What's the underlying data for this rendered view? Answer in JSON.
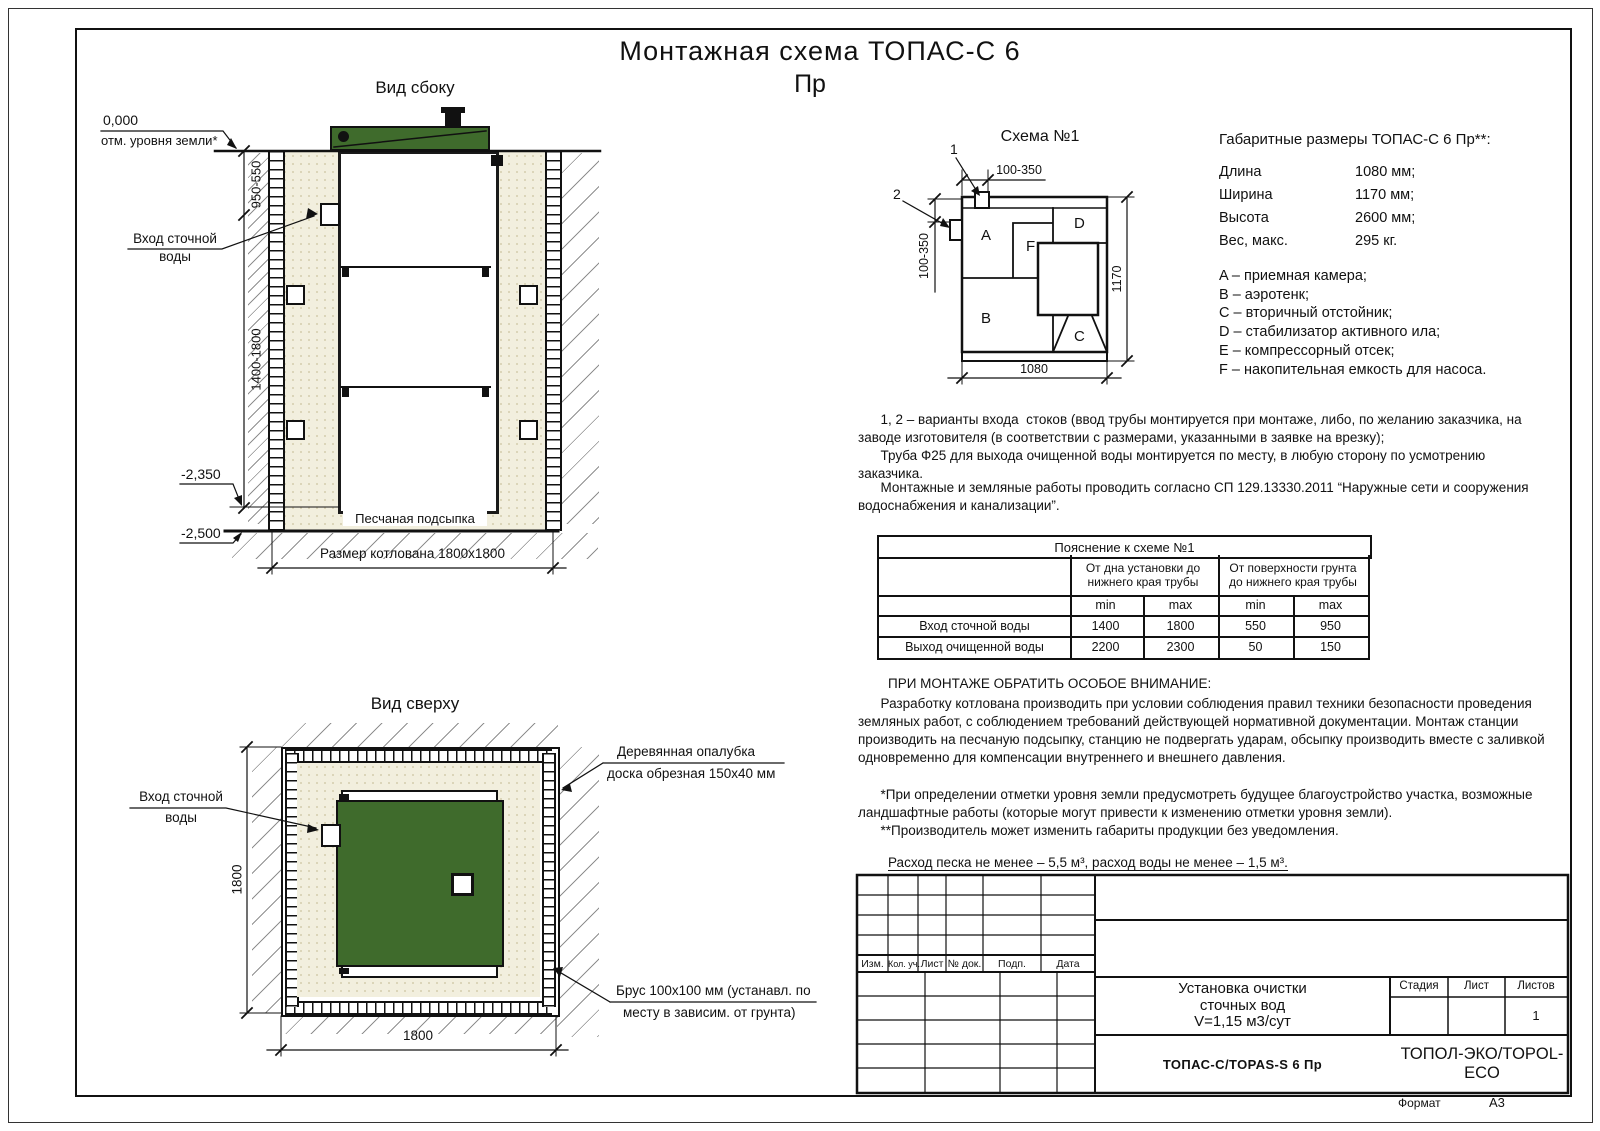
{
  "sheet": {
    "title_line1": "Монтажная схема ТОПАС-С 6",
    "title_line2": "Пр",
    "format_label": "Формат",
    "format_value": "А3"
  },
  "side_view": {
    "title": "Вид сбоку",
    "level_zero": "0,000",
    "level_zero_label": "отм. уровня земли*",
    "dim_upper": "950-550",
    "dim_lower": "1400-1800",
    "level_tank_bottom": "-2,350",
    "level_pit_bottom": "-2,500",
    "inlet_label_line1": "Вход сточной",
    "inlet_label_line2": "воды",
    "sand_label": "Песчаная подсыпка",
    "pit_dim": "Размер котлована 1800x1800"
  },
  "top_view": {
    "title": "Вид сверху",
    "inlet_label_line1": "Вход сточной",
    "inlet_label_line2": "воды",
    "dim_vertical": "1800",
    "dim_horizontal": "1800",
    "formwork_label_line1": "Деревянная опалубка",
    "formwork_label_line2": "доска обрезная 150x40 мм",
    "beam_label_line1": "Брус 100x100 мм (устанавл. по",
    "beam_label_line2": "месту в зависим. от грунта)"
  },
  "schema": {
    "title": "Схема №1",
    "marker1": "1",
    "marker2": "2",
    "dim_top": "100-350",
    "dim_left": "100-350",
    "dim_right": "1170",
    "dim_bottom": "1080",
    "compartments": {
      "A": "A",
      "B": "B",
      "C": "C",
      "D": "D",
      "E": "E",
      "F": "F"
    }
  },
  "specs": {
    "title": "Габаритные размеры ТОПАС-С 6 Пр**:",
    "rows": [
      {
        "label": "Длина",
        "value": "1080 мм;"
      },
      {
        "label": "Ширина",
        "value": "1170 мм;"
      },
      {
        "label": "Высота",
        "value": "2600 мм;"
      },
      {
        "label": "Вес, макс.",
        "value": "295 кг."
      }
    ],
    "legend": [
      "A – приемная камера;",
      "B – аэротенк;",
      "C – вторичный отстойник;",
      "D – стабилизатор активного ила;",
      "E – компрессорный отсек;",
      "F – накопительная емкость для насоса."
    ]
  },
  "notes": {
    "inlet_note": [
      "      1, 2 – варианты входа  стоков (ввод трубы монтируется при монтаже, либо, по желанию заказчика, на",
      "заводе изготовителя (в соответствии с размерами, указанными в заявке на врезку);",
      "      Труба Ф25 для выхода очищенной воды монтируется по месту, в любую сторону по усмотрению заказчика."
    ],
    "mounting_note": [
      "      Монтажные и земляные работы проводить согласно СП 129.13330.2011 “Наружные сети и сооружения",
      "водоснабжения и канализации”."
    ],
    "attention_title": "ПРИ МОНТАЖЕ ОБРАТИТЬ ОСОБОЕ ВНИМАНИЕ:",
    "attention_body": [
      "      Разработку котлована производить при условии соблюдения правил техники безопасности проведения",
      "земляных работ, с соблюдением требований действующей нормативной документации. Монтаж станции",
      "производить на песчаную подсыпку, станцию не подвергать ударам, обсыпку производить вместе с заливкой",
      "одновременно для компенсации внутреннего и внешнего давления."
    ],
    "footnotes": [
      "      *При определении отметки уровня земли предусмотреть будущее благоустройство участка, возможные",
      "ландшафтные работы (которые могут привести к изменению отметки уровня земли).",
      "      **Производитель может изменить габариты продукции без уведомления."
    ],
    "consumption": "Расход песка не менее – 5,5 м³, расход воды не менее – 1,5 м³."
  },
  "explain_table": {
    "title": "Пояснение к схеме №1",
    "group1": "От дна установки до\nнижнего края трубы",
    "group2": "От поверхности грунта\nдо нижнего края трубы",
    "min1": "min",
    "max1": "max",
    "min2": "min",
    "max2": "max",
    "rows": [
      {
        "label": "Вход сточной воды",
        "v1": "1400",
        "v2": "1800",
        "v3": "550",
        "v4": "950"
      },
      {
        "label": "Выход очищенной воды",
        "v1": "2200",
        "v2": "2300",
        "v3": "50",
        "v4": "150"
      }
    ]
  },
  "title_block": {
    "rev_headers": [
      "Изм.",
      "Кол. уч.",
      "Лист",
      "№ док.",
      "Подп.",
      "Дата"
    ],
    "doc_title": [
      "Установка очистки",
      "сточных вод",
      "V=1,15 м3/сут"
    ],
    "stage_label": "Стадия",
    "sheet_label": "Лист",
    "sheets_label": "Листов",
    "sheets_value": "1",
    "model": "ТОПАС-С/TOPAS-S 6 Пр",
    "company": "ТОПОЛ-ЭКО/TOPOL-ECO"
  },
  "colors": {
    "lid_green": "#3f6b2c",
    "sand": "#f2efde",
    "line": "#111111"
  }
}
